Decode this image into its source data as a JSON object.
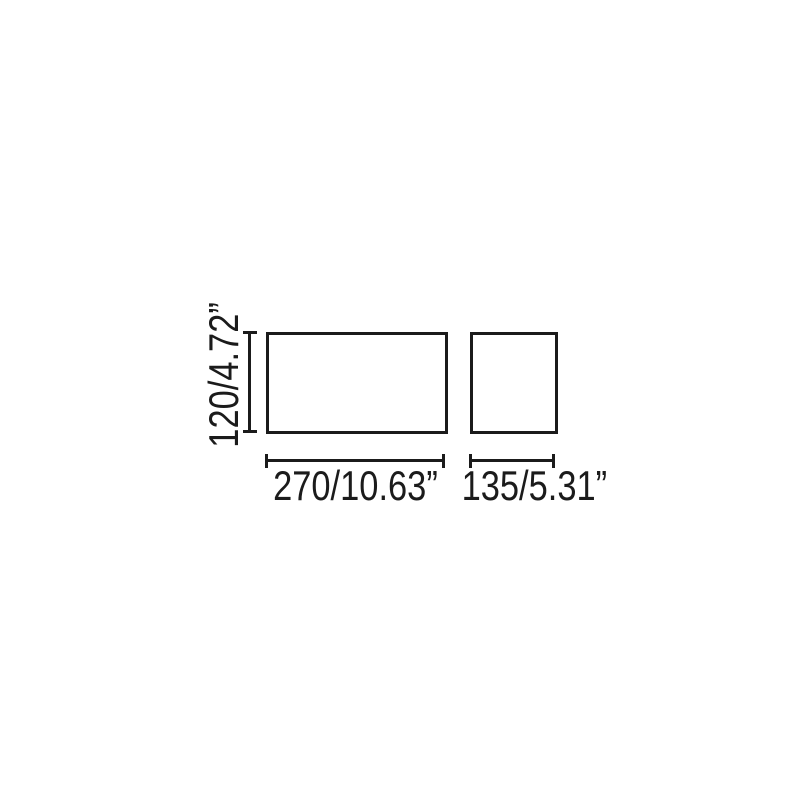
{
  "diagram": {
    "background_color": "#ffffff",
    "line_color": "#1b1b1b",
    "height_dimension": {
      "label": "120/4.72”",
      "value_mm": 120,
      "value_inches": 4.72
    },
    "front_width_dimension": {
      "label": "270/10.63”",
      "value_mm": 270,
      "value_inches": 10.63
    },
    "side_width_dimension": {
      "label": "135/5.31”",
      "value_mm": 135,
      "value_inches": 5.31
    }
  }
}
